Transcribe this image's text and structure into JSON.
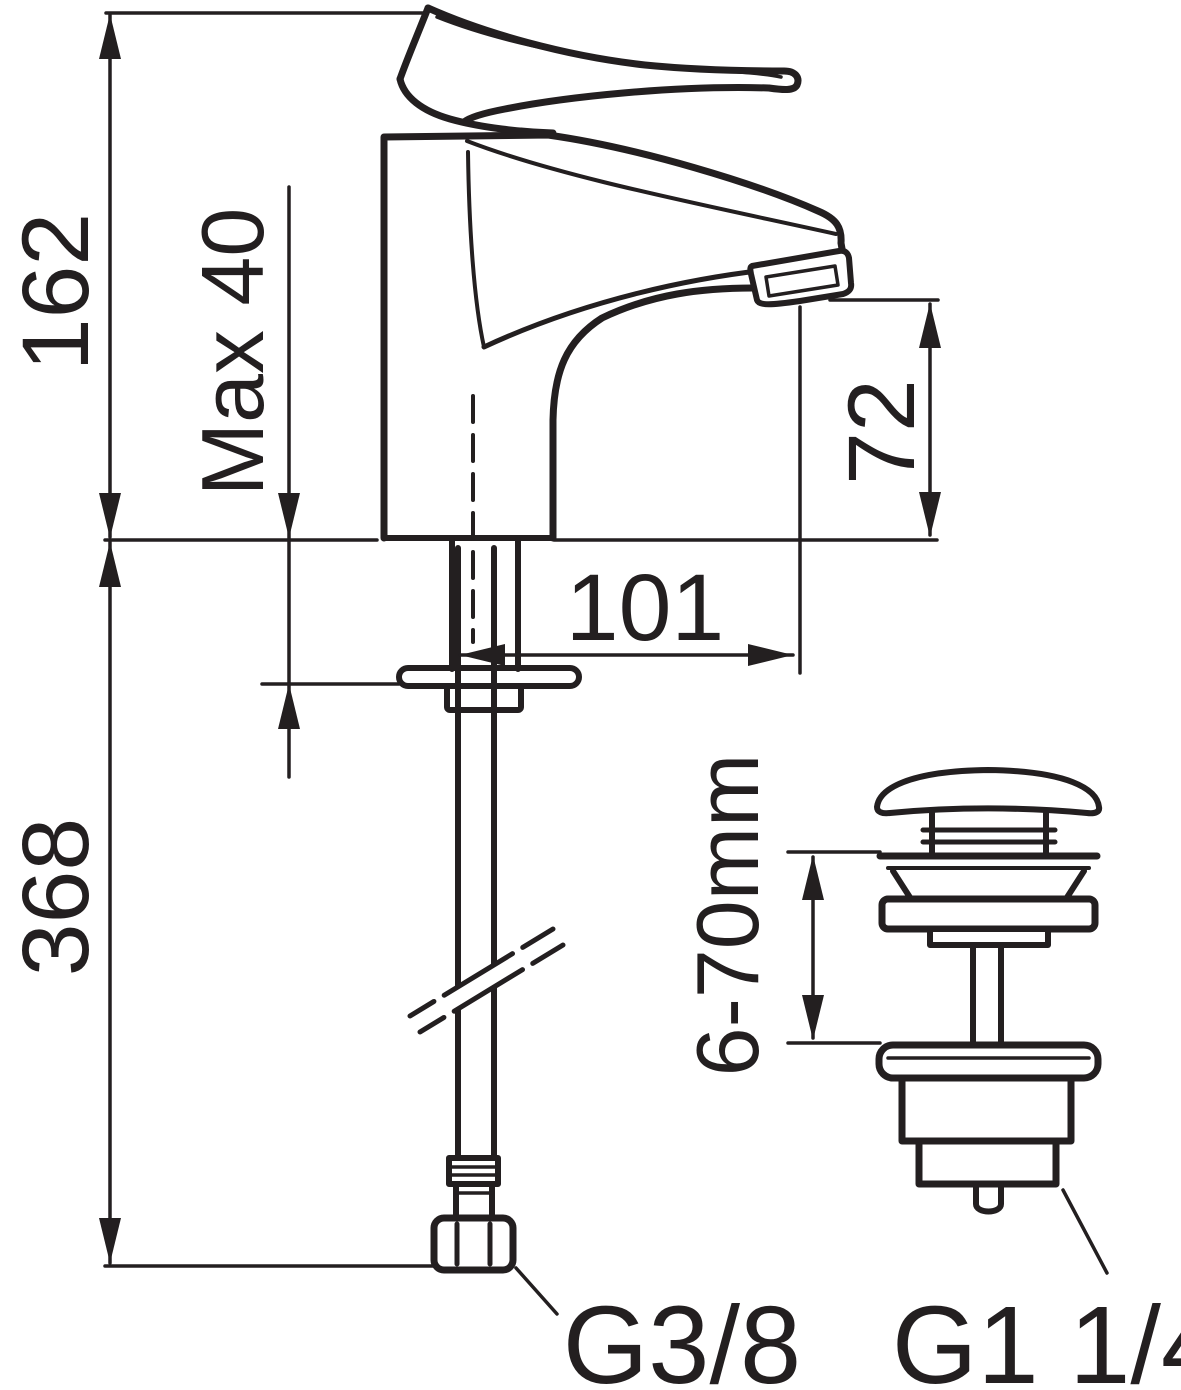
{
  "meta": {
    "type": "technical-dimension-drawing",
    "subject": "single-lever basin mixer faucet with flexible supply hose and pop-up waste valve",
    "background_color": "#ffffff",
    "line_color": "#231f20"
  },
  "dimensions": {
    "total_height": "162",
    "max_deck_thickness": "Max 40",
    "below_deck_length": "368",
    "spout_reach": "101",
    "spout_height": "72",
    "waste_clamp_range": "6-70mm"
  },
  "connections": {
    "supply_thread": "G3/8",
    "waste_thread": "G1 1/4"
  }
}
